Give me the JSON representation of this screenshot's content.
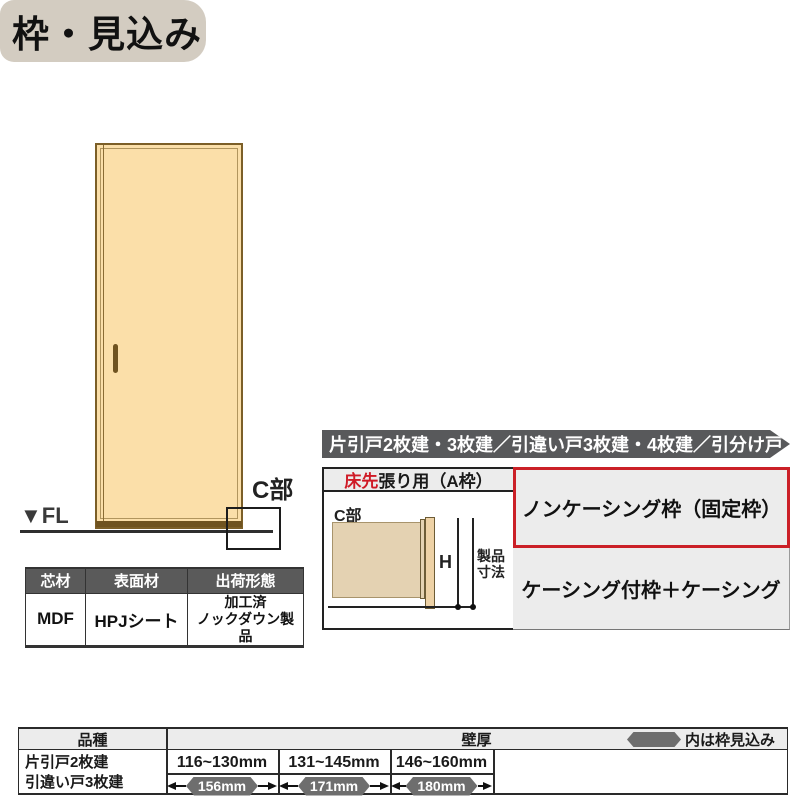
{
  "page": {
    "title": "枠・見込み"
  },
  "door_figure": {
    "fl_label": "▼FL",
    "c_label": "C部"
  },
  "spec_table": {
    "headers": [
      "芯材",
      "表面材",
      "出荷形態"
    ],
    "row": {
      "core": "MDF",
      "surface": "HPJシート",
      "shipping_line1": "加工済",
      "shipping_line2": "ノックダウン製品"
    }
  },
  "panel": {
    "header": "片引戸2枚建・3枚建／引違い戸3枚建・4枚建／引分け戸",
    "floor_type": {
      "red": "床先",
      "rest": "張り用（A枠）"
    },
    "diagram": {
      "c_label": "C部",
      "h_label": "H",
      "dim_label_line1": "製品",
      "dim_label_line2": "寸法"
    },
    "options": [
      {
        "label": "ノンケーシング枠（固定枠）",
        "highlighted": true
      },
      {
        "label": "ケーシング付枠＋ケーシング",
        "highlighted": false
      }
    ]
  },
  "size_table": {
    "col1_header": "品種",
    "col2_header": "壁厚",
    "legend": "内は枠見込み",
    "products": [
      "片引戸2枚建",
      "引違い戸3枚建"
    ],
    "columns": [
      {
        "range": "116~130mm",
        "depth": "156mm"
      },
      {
        "range": "131~145mm",
        "depth": "171mm"
      },
      {
        "range": "146~160mm",
        "depth": "180mm"
      }
    ]
  },
  "colors": {
    "accent_red": "#cb2027",
    "bar_gray": "#58595b",
    "door_tan": "#fbdfa9",
    "badge_gray": "#6e6e6e",
    "title_bg": "#d3ccc1"
  }
}
